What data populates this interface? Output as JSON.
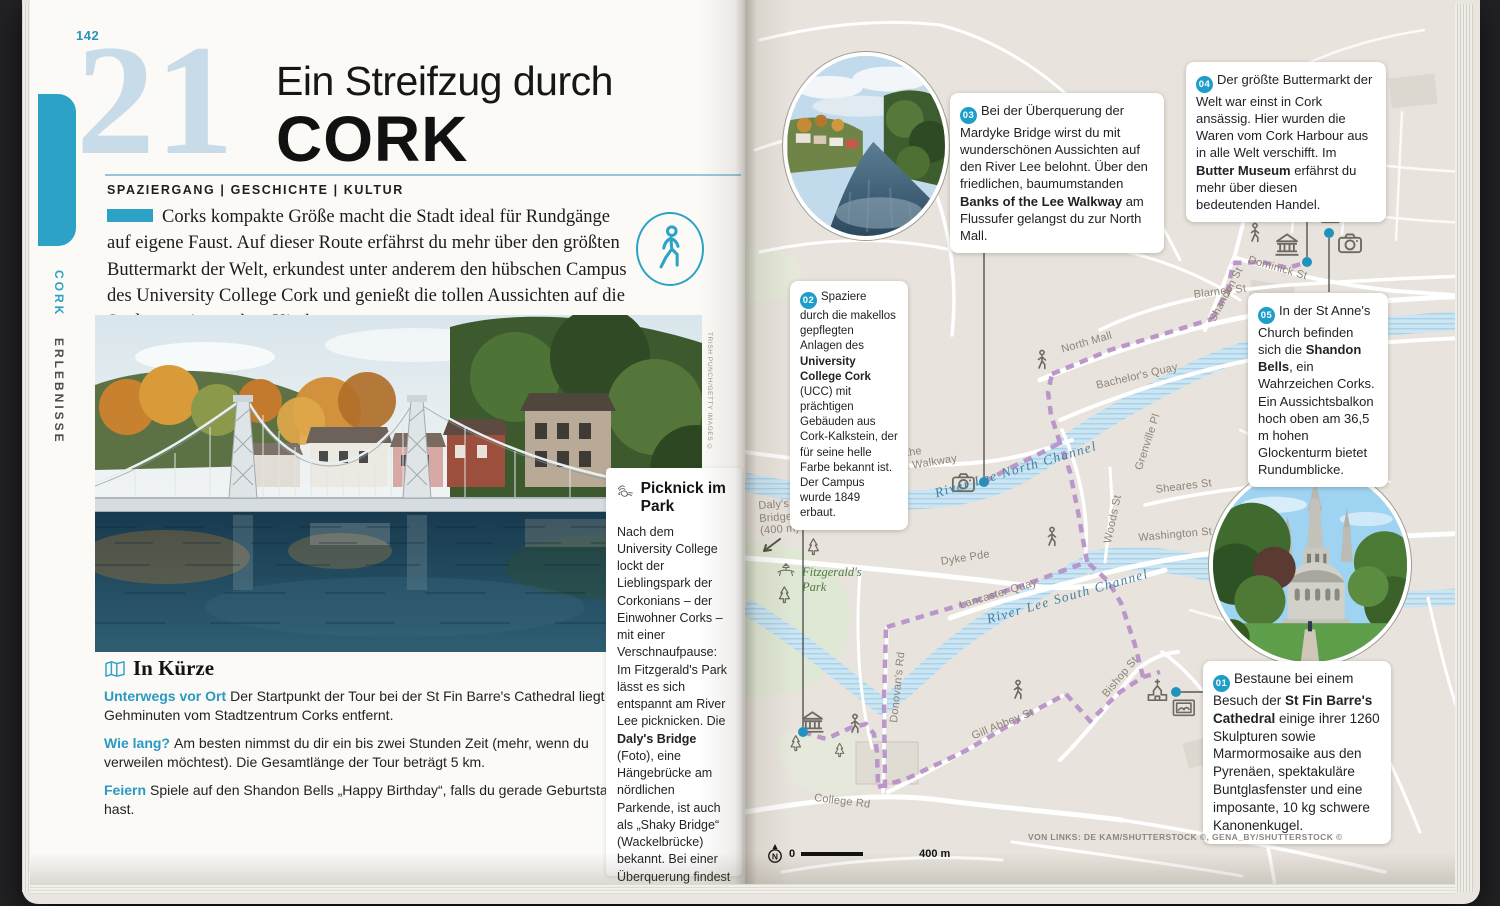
{
  "colors": {
    "accent_teal": "#2ba2c6",
    "badge_teal": "#1d9dc8",
    "chapter_blue": "#c7dbe9",
    "route_purple": "#b791c8",
    "river_blue": "#cbe5f3",
    "map_background": "#e8e4dd",
    "park_green": "#dfe8d4"
  },
  "icons": [
    "map-icon",
    "walking-tour-icon",
    "picnic-icon",
    "walker-icon",
    "museum-icon",
    "church-icon",
    "camera-icon",
    "gallery-icon",
    "pine-tree-icon",
    "compass-north-icon",
    "arrow-icon"
  ],
  "left": {
    "page_number": "142",
    "rail": {
      "primary": "CORK",
      "secondary": "ERLEBNISSE"
    },
    "chapter_number": "21",
    "title_top": "Ein Streifzug durch",
    "title_main": "CORK",
    "kicker": "SPAZIERGANG | GESCHICHTE | KULTUR",
    "intro": "Corks kompakte Größe macht die Stadt ideal für Rundgänge auf eigene Faust. Auf dieser Route erfährst du mehr über den größten Buttermarkt der Welt, erkundest unter anderem den hübschen Campus des University College Cork und genießt die tollen Aussichten auf die Stadt von einem alten Kirchturm aus.",
    "photo_credit": "TRISH PUNCH/GETTY IMAGES ©",
    "in_kuerze": {
      "heading": "In Kürze",
      "items": [
        {
          "label": "Unterwegs vor Ort",
          "text": "Der Startpunkt der Tour bei der St Fin Barre's Cathedral liegt 10 Gehminuten vom Stadtzentrum Corks entfernt."
        },
        {
          "label": "Wie lang?",
          "text": "Am besten nimmst du dir ein bis zwei Stunden Zeit (mehr, wenn du verweilen möchtest). Die Gesamtlänge der Tour beträgt 5 km."
        },
        {
          "label": "Feiern",
          "text": "Spiele auf den Shandon Bells „Happy Birthday“, falls du gerade Geburtstag hast."
        }
      ]
    },
    "sidebar": {
      "heading": "Picknick im Park",
      "body_segments": [
        {
          "t": "Nach dem University College lockt der Lieblingspark der Corkonians – der Einwohner Corks – mit einer Verschnaufpause: Im Fitzgerald's Park lässt es sich entspannt am River Lee picknicken. Die "
        },
        {
          "t": "Daly's Bridge",
          "b": true
        },
        {
          "t": " (Foto), eine Hängebrücke am nördlichen Parkende, ist auch als „Shaky Bridge“ (Wackelbrücke) bekannt. Bei einer Überquerung findest du heraus, warum das so ist."
        }
      ]
    }
  },
  "right": {
    "callouts": [
      {
        "num": "01",
        "segments": [
          {
            "t": "Bestaune bei einem Besuch der "
          },
          {
            "t": "St Fin Barre's Cathedral",
            "b": true
          },
          {
            "t": " einige ihrer 1260 Skulpturen sowie Marmormosaike aus den Pyrenäen, spektakuläre Buntglasfenster und eine imposante, 10 kg schwere Kanonenkugel."
          }
        ]
      },
      {
        "num": "02",
        "segments": [
          {
            "t": "Spaziere durch die makellos gepflegten Anlagen des "
          },
          {
            "t": "University College Cork",
            "b": true
          },
          {
            "t": " (UCC) mit prächtigen Gebäuden aus Cork-Kalkstein, der für seine helle Farbe bekannt ist. Der Campus wurde 1849 erbaut."
          }
        ]
      },
      {
        "num": "03",
        "segments": [
          {
            "t": "Bei der Überquerung der Mardyke Bridge wirst du mit wunderschönen Aussichten auf den River Lee belohnt. Über den friedlichen, baumumstanden "
          },
          {
            "t": "Banks of the Lee Walkway",
            "b": true
          },
          {
            "t": " am Flussufer gelangst du zur North Mall."
          }
        ]
      },
      {
        "num": "04",
        "segments": [
          {
            "t": "Der größte Buttermarkt der Welt war einst in Cork ansässig. Hier wurden die Waren vom Cork Harbour aus in alle Welt verschifft. Im "
          },
          {
            "t": "Butter Museum",
            "b": true
          },
          {
            "t": " erfährst du mehr über diesen bedeutenden Handel."
          }
        ]
      },
      {
        "num": "05",
        "segments": [
          {
            "t": "In der St Anne's Church befinden sich die "
          },
          {
            "t": "Shandon Bells",
            "b": true
          },
          {
            "t": ", ein Wahrzeichen Corks. Ein Aussichtsbalkon hoch oben am 36,5 m hohen Glockenturm bietet Rundumblicke."
          }
        ]
      }
    ],
    "labels": {
      "blarney_st": "Blarney St",
      "shandon_st": "Shandon St",
      "dominick_st": "Dominick St",
      "north_mall": "North Mall",
      "bachelors_quay": "Bachelor's Quay",
      "grenville_pl": "Grenville Pl",
      "sheares_st": "Sheares St",
      "woods_st": "Woods St",
      "washington_st": "Washington St",
      "dyke_pde": "Dyke Pde",
      "lancaster_quay": "Lancaster Quay",
      "river_lee_north": "River Lee North Channel",
      "river_lee_south": "River Lee South Channel",
      "gill_abbey_st": "Gill Abbey St",
      "donovans_rd": "Donovan's Rd",
      "bishop_st": "Bishop St",
      "college_rd": "College Rd",
      "mardyke_bridge": "Mardyke\nBridge",
      "dalys_bridge": "Daly's\nBridge\n(400 m)",
      "banks_walkway": "Banks of the\nRiver Lee Walkway",
      "fitzgeralds_park": "Fitzgerald's\nPark"
    },
    "scale": {
      "zero": "0",
      "distance": "400 m",
      "north": "N"
    },
    "credit": "VON LINKS: DE KAM/SHUTTERSTOCK ©, GENA_BY/SHUTTERSTOCK ©"
  }
}
